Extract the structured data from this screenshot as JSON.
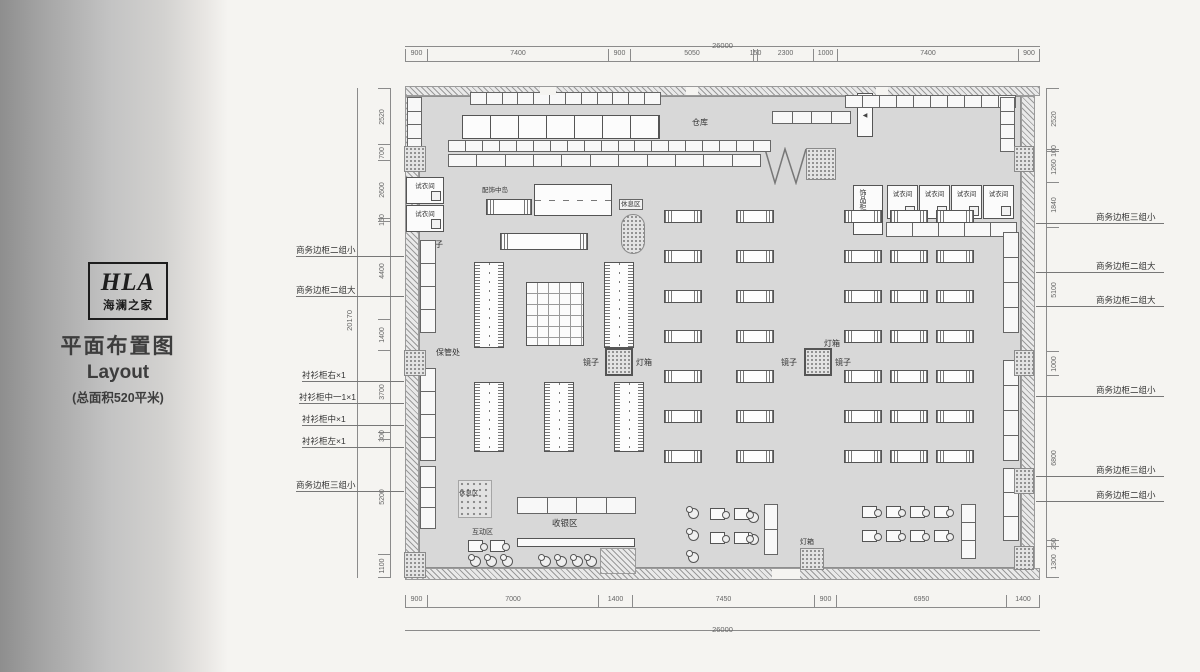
{
  "sidebar": {
    "logo_text": "HLA",
    "logo_subtext": "海澜之家",
    "title_cn": "平面布置图",
    "title_en": "Layout",
    "area_note": "(总面积520平米)"
  },
  "dimensions": {
    "top_total": "26000",
    "top_segments": [
      "900",
      "7400",
      "900",
      "5050",
      "150",
      "2300",
      "1000",
      "7400",
      "900"
    ],
    "bottom_segments": [
      "900",
      "7000",
      "1400",
      "7450",
      "900",
      "6950",
      "1400"
    ],
    "bottom_total": "26000",
    "left_total": "20170",
    "left_segments": [
      "2520",
      "700",
      "2600",
      "150",
      "4400",
      "1400",
      "3700",
      "300",
      "5200",
      "1100"
    ],
    "right_segments": [
      "2520",
      "100",
      "1260",
      "1840",
      "5100",
      "1000",
      "6800",
      "250",
      "1300"
    ]
  },
  "wall_labels_left": [
    "商务边柜二组小",
    "商务边柜二组大",
    "衬衫柜右×1",
    "衬衫柜中一1×1",
    "衬衫柜中×1",
    "衬衫柜左×1",
    "商务边柜三组小"
  ],
  "wall_labels_right": [
    "商务边柜三组小",
    "商务边柜二组大",
    "商务边柜二组大",
    "商务边柜二组小",
    "商务边柜三组小",
    "商务边柜二组小"
  ],
  "room_labels": {
    "warehouse": "仓库",
    "fitting_room": "试衣间",
    "accessory_cabinet": "饰品柜",
    "accessory_island": "配饰中岛",
    "rest_area": "休息区",
    "mirror": "镜子",
    "light_box": "灯箱",
    "storage": "保管处",
    "cashier_area": "收银区",
    "interactive_area": "互动区"
  },
  "icons": {
    "entry_arrow": "◀"
  },
  "colors": {
    "floor": "#d8d8d8",
    "wall_line": "#8f8f8f",
    "fixture_line": "#555555",
    "dim_text": "#666666",
    "sidebar_dark": "#8e8e8e",
    "page_bg": "#f5f4f1"
  }
}
